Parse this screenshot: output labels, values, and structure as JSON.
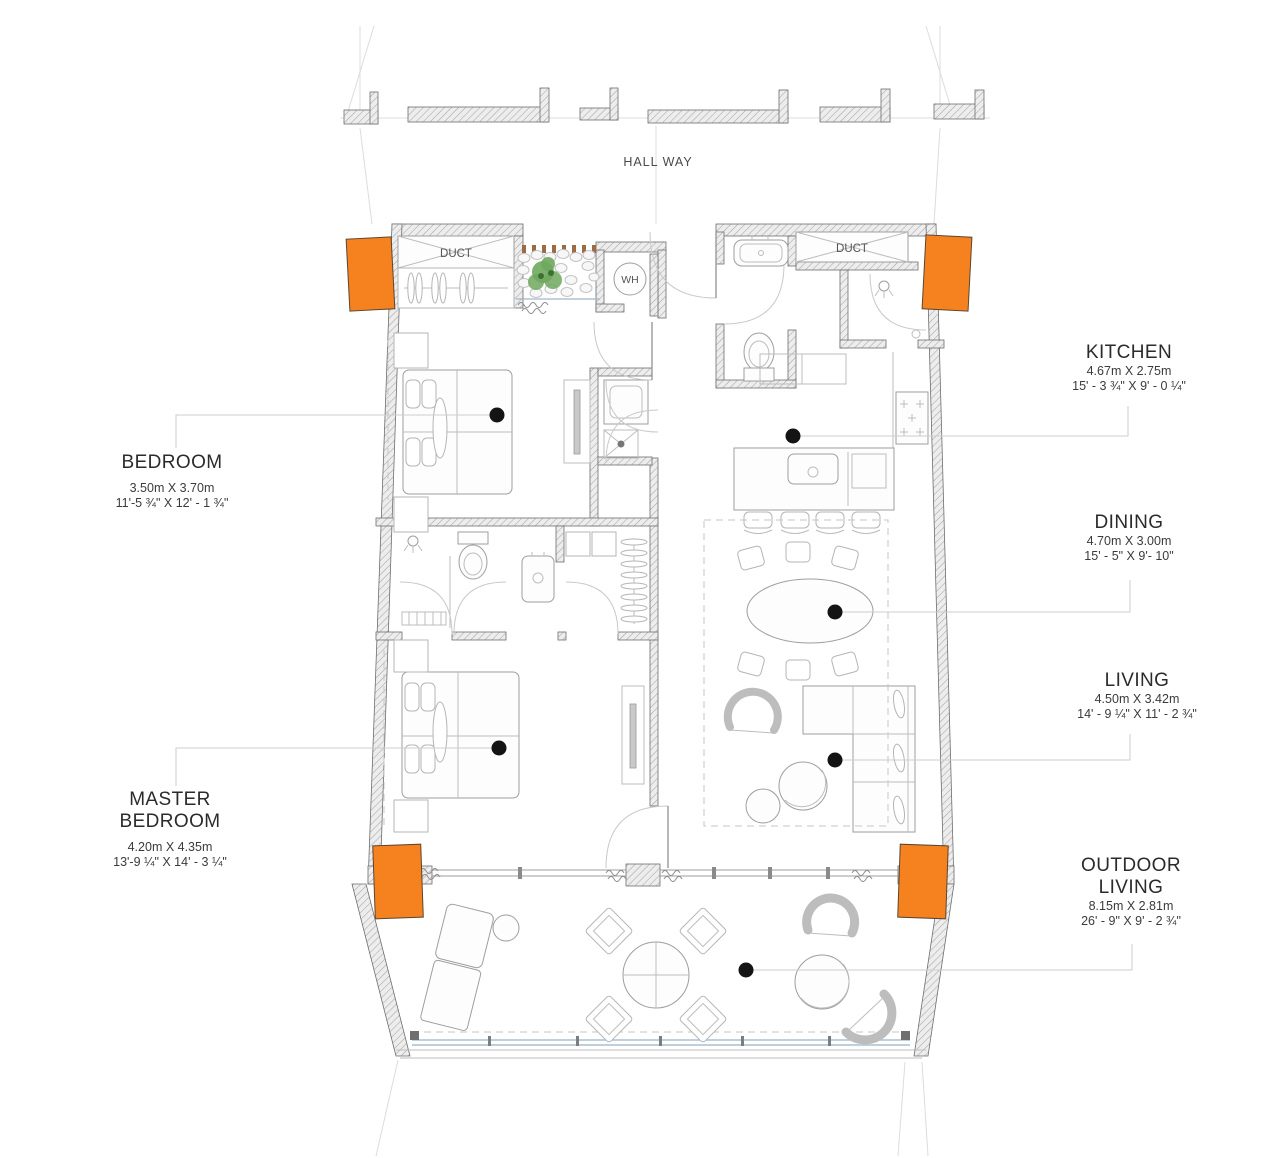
{
  "drawing": {
    "hallway_label": "HALL WAY",
    "duct_left_label": "DUCT",
    "duct_right_label": "DUCT",
    "water_heater_label": "WH"
  },
  "rooms": {
    "bedroom": {
      "title": "BEDROOM",
      "metric": "3.50m X 3.70m",
      "imperial": "11'-5 ¾\" X 12' - 1 ¾\""
    },
    "master_bedroom": {
      "title_line1": "MASTER",
      "title_line2": "BEDROOM",
      "metric": "4.20m X 4.35m",
      "imperial": "13'-9 ¼\" X 14' - 3 ¼\""
    },
    "kitchen": {
      "title": "KITCHEN",
      "metric": "4.67m X 2.75m",
      "imperial": "15' - 3 ¾\" X 9' - 0 ¼\""
    },
    "dining": {
      "title": "DINING",
      "metric": "4.70m X 3.00m",
      "imperial": "15' - 5\"  X 9'- 10\""
    },
    "living": {
      "title": "LIVING",
      "metric": "4.50m X 3.42m",
      "imperial": "14' - 9 ¼\"  X 11' - 2 ¾\""
    },
    "outdoor_living": {
      "title_line1": "OUTDOOR",
      "title_line2": "LIVING",
      "metric": "8.15m X 2.81m",
      "imperial": "26' - 9\" X 9' - 2 ¾\""
    }
  },
  "colors": {
    "column_orange": "#F5821F",
    "marker_black": "#141414",
    "railing_blue": "#A9C0CF",
    "plant_green": "#6FA85E"
  }
}
